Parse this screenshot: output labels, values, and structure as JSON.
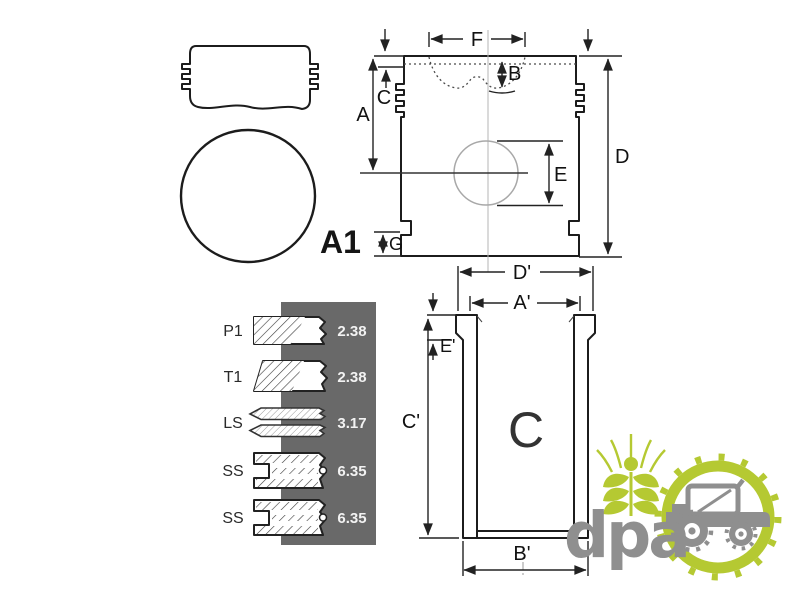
{
  "drawing": {
    "crown_label": "A1",
    "piston_dims": {
      "a": "A",
      "b": "B",
      "c": "C",
      "d": "D",
      "e": "E",
      "f": "F",
      "g": "G"
    },
    "liner_label": "C",
    "liner_dims": {
      "d": "D'",
      "a": "A'",
      "e": "E'",
      "c": "C'",
      "b": "B'"
    }
  },
  "ring_table": {
    "panel_color": "#696969",
    "text_color": "#f2f2f2",
    "rows": [
      {
        "label": "P1",
        "value": "2.38"
      },
      {
        "label": "T1",
        "value": "2.38"
      },
      {
        "label": "LS",
        "value": "3.17"
      },
      {
        "label": "SS",
        "value": "6.35"
      },
      {
        "label": "SS",
        "value": "6.35"
      }
    ]
  },
  "logo": {
    "text": "dpa",
    "green": "#b5c932",
    "gray": "#8f8f8f"
  },
  "colors": {
    "line": "#1c1c1c",
    "dim": "#222222",
    "light": "#a8a8a8"
  }
}
